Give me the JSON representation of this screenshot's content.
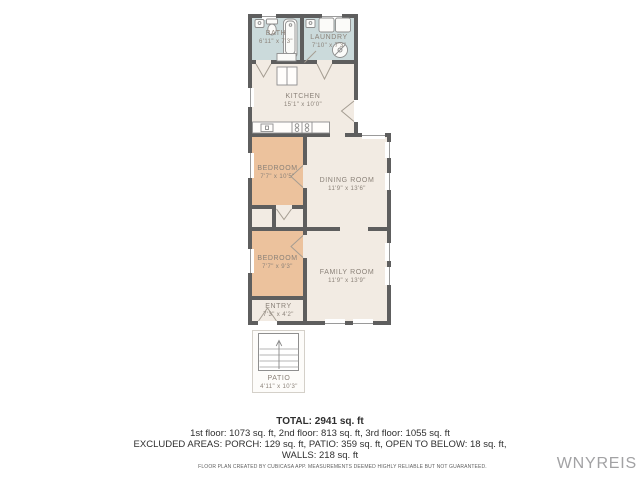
{
  "floorplan": {
    "rooms": [
      {
        "id": "bath",
        "name": "BATH",
        "dims": "6'11\" x 7'3\""
      },
      {
        "id": "laundry",
        "name": "LAUNDRY",
        "dims": "7'10\" x 7'3\""
      },
      {
        "id": "kitchen",
        "name": "KITCHEN",
        "dims": "15'1\" x 10'0\""
      },
      {
        "id": "bedroom-1",
        "name": "BEDROOM",
        "dims": "7'7\" x 10'5\""
      },
      {
        "id": "dining-room",
        "name": "DINING ROOM",
        "dims": "11'9\" x 13'6\""
      },
      {
        "id": "bedroom-2",
        "name": "BEDROOM",
        "dims": "7'7\" x 9'3\""
      },
      {
        "id": "family-room",
        "name": "FAMILY ROOM",
        "dims": "11'9\" x 13'9\""
      },
      {
        "id": "entry",
        "name": "ENTRY",
        "dims": "7'3\" x 4'2\""
      },
      {
        "id": "patio",
        "name": "PATIO",
        "dims": "4'11\" x 10'3\""
      }
    ],
    "colors": {
      "wall": "#5e5e5e",
      "floor_living": "#f2ebe3",
      "floor_bedroom": "#ecc29d",
      "floor_wet_room": "#cbdadb",
      "label_text": "#8b8279"
    }
  },
  "summary": {
    "total": "TOTAL: 2941 sq. ft",
    "floors_line": "1st floor: 1073 sq. ft, 2nd floor: 813 sq. ft, 3rd floor: 1055 sq. ft",
    "excluded_line": "EXCLUDED AREAS: PORCH: 129 sq. ft, PATIO: 359 sq. ft, OPEN TO BELOW: 18 sq. ft,",
    "walls_line": "WALLS: 218 sq. ft"
  },
  "footer": {
    "disclaimer": "FLOOR PLAN CREATED BY CUBICASA APP. MEASUREMENTS DEEMED HIGHLY RELIABLE BUT NOT GUARANTEED.",
    "watermark": "WNYREIS"
  }
}
